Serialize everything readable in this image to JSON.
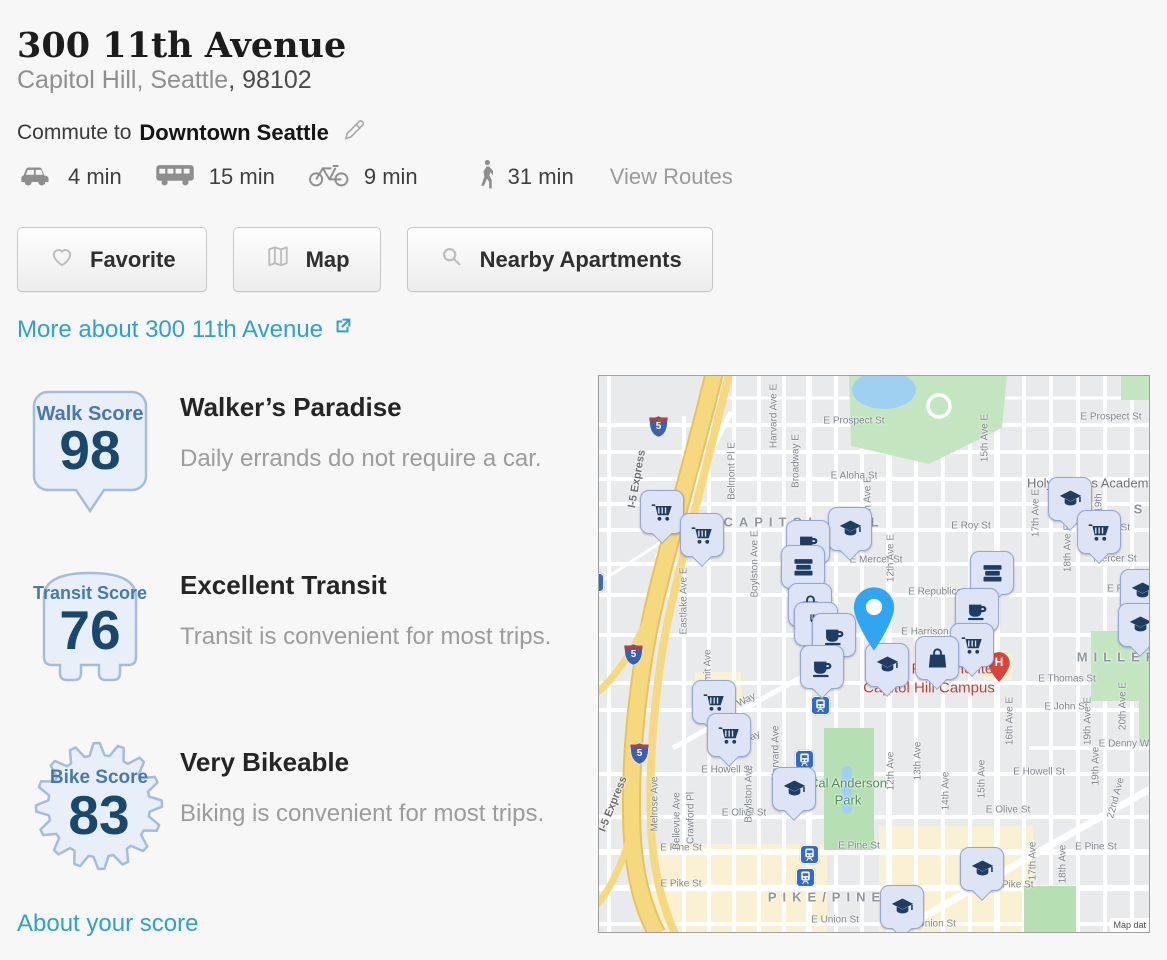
{
  "page": {
    "title": "300 11th Avenue",
    "subtitle_area": "Capitol Hill, Seattle",
    "subtitle_zip": ", 98102",
    "commute_prefix": "Commute to",
    "commute_destination": "Downtown Seattle",
    "view_routes": "View Routes",
    "more_link": "More about 300 11th Avenue",
    "about_link": "About your score"
  },
  "colors": {
    "link_blue": "#2d9fdb",
    "badge_fill": "#e9eff9",
    "badge_border": "#a5bddc",
    "badge_label_blue": "#4579b2",
    "badge_number_navy": "#18486e",
    "pin_fill": "#dde4f6",
    "pin_border": "#94a6d8",
    "pin_glyph_navy": "#1d3d63",
    "main_pin_blue": "#2fa6f2",
    "hospital_red": "#d9453c",
    "campus_text_red": "#cc3b33",
    "park_green": "#c3e6c0",
    "highway_yellow": "#f5d774"
  },
  "commute_times": [
    {
      "icon": "car-icon",
      "time": "4 min"
    },
    {
      "icon": "bus-icon",
      "time": "15 min"
    },
    {
      "icon": "bike-icon",
      "time": "9 min"
    },
    {
      "icon": "walk-icon",
      "time": "31 min"
    }
  ],
  "buttons": [
    {
      "icon": "heart-icon",
      "label": "Favorite"
    },
    {
      "icon": "map-icon",
      "label": "Map"
    },
    {
      "icon": "search-icon",
      "label": "Nearby Apartments"
    }
  ],
  "scores": [
    {
      "badge_label": "Walk Score",
      "value": "98",
      "heading": "Walker’s Paradise",
      "description": "Daily errands do not require a car."
    },
    {
      "badge_label": "Transit Score",
      "value": "76",
      "heading": "Excellent Transit",
      "description": "Transit is convenient for most trips."
    },
    {
      "badge_label": "Bike Score",
      "value": "83",
      "heading": "Very Bikeable",
      "description": "Biking is convenient for most trips."
    }
  ],
  "map": {
    "attribution": "Map dat",
    "main_pin": {
      "tip_x": 275,
      "tip_y": 276
    },
    "hospital": {
      "label": "H",
      "x": 400,
      "y": 290
    },
    "shields": [
      {
        "label": "5",
        "x": 59,
        "y": 50
      },
      {
        "label": "5",
        "x": 34,
        "y": 278
      },
      {
        "label": "5",
        "x": 40,
        "y": 377
      }
    ],
    "transit_icons": [
      {
        "x": 220,
        "y": 328
      },
      {
        "x": 204,
        "y": 382
      },
      {
        "x": 209,
        "y": 477
      },
      {
        "x": 205,
        "y": 500
      },
      {
        "x": -6,
        "y": 205
      }
    ],
    "pins": [
      {
        "icon": "cart",
        "x": 62,
        "y": 135
      },
      {
        "icon": "cart",
        "x": 102,
        "y": 158
      },
      {
        "icon": "gradcap",
        "x": 250,
        "y": 152
      },
      {
        "icon": "coffee",
        "x": 208,
        "y": 165
      },
      {
        "icon": "gradcap",
        "x": 470,
        "y": 122
      },
      {
        "icon": "cart",
        "x": 499,
        "y": 155
      },
      {
        "icon": "books",
        "x": 203,
        "y": 190
      },
      {
        "icon": "books",
        "x": 392,
        "y": 196
      },
      {
        "icon": "gradcap",
        "x": 542,
        "y": 214
      },
      {
        "icon": "bag",
        "x": 210,
        "y": 228
      },
      {
        "icon": "coffee",
        "x": 377,
        "y": 233
      },
      {
        "icon": "restaurant",
        "x": 216,
        "y": 247
      },
      {
        "icon": "gradcap",
        "x": 540,
        "y": 248
      },
      {
        "icon": "coffee",
        "x": 234,
        "y": 258
      },
      {
        "icon": "cart",
        "x": 372,
        "y": 268
      },
      {
        "icon": "bag",
        "x": 337,
        "y": 281
      },
      {
        "icon": "gradcap",
        "x": 287,
        "y": 288
      },
      {
        "icon": "coffee",
        "x": 222,
        "y": 290
      },
      {
        "icon": "cart",
        "x": 114,
        "y": 325
      },
      {
        "icon": "cart",
        "x": 129,
        "y": 358
      },
      {
        "icon": "gradcap",
        "x": 194,
        "y": 412
      },
      {
        "icon": "gradcap",
        "x": 382,
        "y": 492
      },
      {
        "icon": "gradcap",
        "x": 302,
        "y": 530
      }
    ],
    "labels": [
      {
        "text": "E Prospect St",
        "x": 255,
        "y": 45,
        "cls": "st"
      },
      {
        "text": "E Prospect St",
        "x": 512,
        "y": 41,
        "cls": "st"
      },
      {
        "text": "E Aloha St",
        "x": 255,
        "y": 100,
        "cls": "st"
      },
      {
        "text": "E Roy St",
        "x": 372,
        "y": 150,
        "cls": "st"
      },
      {
        "text": "Roy St",
        "x": 516,
        "y": 152,
        "cls": "st"
      },
      {
        "text": "E Mercer St",
        "x": 277,
        "y": 184,
        "cls": "st"
      },
      {
        "text": "Mercer St",
        "x": 516,
        "y": 183,
        "cls": "st"
      },
      {
        "text": "E Republican St",
        "x": 345,
        "y": 216,
        "cls": "st"
      },
      {
        "text": "E Republica",
        "x": 535,
        "y": 213,
        "cls": "st"
      },
      {
        "text": "E Harrison St",
        "x": 332,
        "y": 256,
        "cls": "st"
      },
      {
        "text": "E Thomas St",
        "x": 468,
        "y": 303,
        "cls": "st"
      },
      {
        "text": "E John St",
        "x": 467,
        "y": 331,
        "cls": "st"
      },
      {
        "text": "E Denny Way",
        "x": 530,
        "y": 368,
        "cls": "st"
      },
      {
        "text": "E Howell St",
        "x": 128,
        "y": 394,
        "cls": "st"
      },
      {
        "text": "E Howell St",
        "x": 440,
        "y": 396,
        "cls": "st"
      },
      {
        "text": "E Olive St",
        "x": 145,
        "y": 437,
        "cls": "st"
      },
      {
        "text": "E Olive St",
        "x": 409,
        "y": 434,
        "cls": "st"
      },
      {
        "text": "E Pine St",
        "x": 82,
        "y": 472,
        "cls": "st"
      },
      {
        "text": "E Pine St",
        "x": 260,
        "y": 470,
        "cls": "st"
      },
      {
        "text": "E Pine St",
        "x": 497,
        "y": 471,
        "cls": "st"
      },
      {
        "text": "E Pike St",
        "x": 82,
        "y": 508,
        "cls": "st"
      },
      {
        "text": "E Pike St",
        "x": 414,
        "y": 509,
        "cls": "st"
      },
      {
        "text": "E Union St",
        "x": 236,
        "y": 544,
        "cls": "st"
      },
      {
        "text": "E Union St",
        "x": 333,
        "y": 548,
        "cls": "st"
      },
      {
        "text": "Eastlake Ave E",
        "x": 85,
        "y": 225,
        "cls": "st",
        "rot": -90
      },
      {
        "text": "Belmont Pl E",
        "x": 133,
        "y": 95,
        "cls": "st",
        "rot": -90
      },
      {
        "text": "Boylston Ave E",
        "x": 156,
        "y": 188,
        "cls": "st",
        "rot": -90
      },
      {
        "text": "Harvard Ave E",
        "x": 175,
        "y": 40,
        "cls": "st",
        "rot": -90
      },
      {
        "text": "Broadway E",
        "x": 197,
        "y": 85,
        "cls": "st",
        "rot": -90
      },
      {
        "text": "11th Ave E",
        "x": 269,
        "y": 124,
        "cls": "st",
        "rot": -90
      },
      {
        "text": "12th Ave E",
        "x": 292,
        "y": 182,
        "cls": "st",
        "rot": -90
      },
      {
        "text": "15th Ave E",
        "x": 386,
        "y": 62,
        "cls": "st",
        "rot": -90
      },
      {
        "text": "17th Ave E",
        "x": 437,
        "y": 137,
        "cls": "st",
        "rot": -90
      },
      {
        "text": "18th Ave E",
        "x": 469,
        "y": 172,
        "cls": "st",
        "rot": -90
      },
      {
        "text": "19th",
        "x": 500,
        "y": 127,
        "cls": "st",
        "rot": -90
      },
      {
        "text": "16th Ave E",
        "x": 411,
        "y": 345,
        "cls": "st",
        "rot": -90
      },
      {
        "text": "19th Ave E",
        "x": 489,
        "y": 345,
        "cls": "st",
        "rot": -90
      },
      {
        "text": "20th Ave E",
        "x": 524,
        "y": 330,
        "cls": "st",
        "rot": -90
      },
      {
        "text": "12th Ave",
        "x": 292,
        "y": 395,
        "cls": "st",
        "rot": -90
      },
      {
        "text": "13th Ave",
        "x": 319,
        "y": 385,
        "cls": "st",
        "rot": -90
      },
      {
        "text": "14th Ave",
        "x": 347,
        "y": 415,
        "cls": "st",
        "rot": -90
      },
      {
        "text": "15th Ave",
        "x": 383,
        "y": 403,
        "cls": "st",
        "rot": -90
      },
      {
        "text": "17th Ave",
        "x": 434,
        "y": 485,
        "cls": "st",
        "rot": -90
      },
      {
        "text": "18th Ave",
        "x": 464,
        "y": 488,
        "cls": "st",
        "rot": -90
      },
      {
        "text": "19th Ave",
        "x": 497,
        "y": 390,
        "cls": "st",
        "rot": -90
      },
      {
        "text": "22nd Ave",
        "x": 517,
        "y": 422,
        "cls": "st",
        "rot": -75
      },
      {
        "text": "Bellevue Ave",
        "x": 78,
        "y": 445,
        "cls": "st",
        "rot": -90
      },
      {
        "text": "Melrose Ave",
        "x": 56,
        "y": 428,
        "cls": "st",
        "rot": -90
      },
      {
        "text": "Crawford Pl",
        "x": 92,
        "y": 442,
        "cls": "st",
        "rot": -90
      },
      {
        "text": "Boylston Ave",
        "x": 150,
        "y": 418,
        "cls": "st",
        "rot": -90
      },
      {
        "text": "Harvard Ave",
        "x": 177,
        "y": 377,
        "cls": "st",
        "rot": -90
      },
      {
        "text": "Summit Ave",
        "x": 109,
        "y": 300,
        "cls": "st",
        "rot": -90
      },
      {
        "text": "Olive Way",
        "x": 136,
        "y": 330,
        "cls": "st",
        "rot": -27
      },
      {
        "text": "Way",
        "x": 152,
        "y": 362,
        "cls": "st",
        "rot": -27
      },
      {
        "text": "I-5 Express",
        "x": 38,
        "y": 103,
        "cls": "hwy",
        "rot": -80
      },
      {
        "text": "I-5 Express",
        "x": 14,
        "y": 428,
        "cls": "hwy",
        "rot": -68
      },
      {
        "text": "CAPITOL HILL",
        "x": 205,
        "y": 146,
        "cls": "district"
      },
      {
        "text": "PIKE/PINE",
        "x": 228,
        "y": 521,
        "cls": "district"
      },
      {
        "text": "MILLER",
        "x": 520,
        "y": 281,
        "cls": "district"
      },
      {
        "text": "S",
        "x": 542,
        "y": 133,
        "cls": "district"
      },
      {
        "text": "Holy Names Academy",
        "x": 492,
        "y": 107,
        "cls": "poi"
      },
      {
        "text": "Cal Anderson",
        "x": 249,
        "y": 407,
        "cls": "park"
      },
      {
        "text": "Park",
        "x": 249,
        "y": 424,
        "cls": "park"
      },
      {
        "text": "Kaiser Permanente",
        "x": 330,
        "y": 293,
        "cls": "hosp"
      },
      {
        "text": "Capitol Hill Campus",
        "x": 330,
        "y": 312,
        "cls": "hosp"
      }
    ]
  }
}
